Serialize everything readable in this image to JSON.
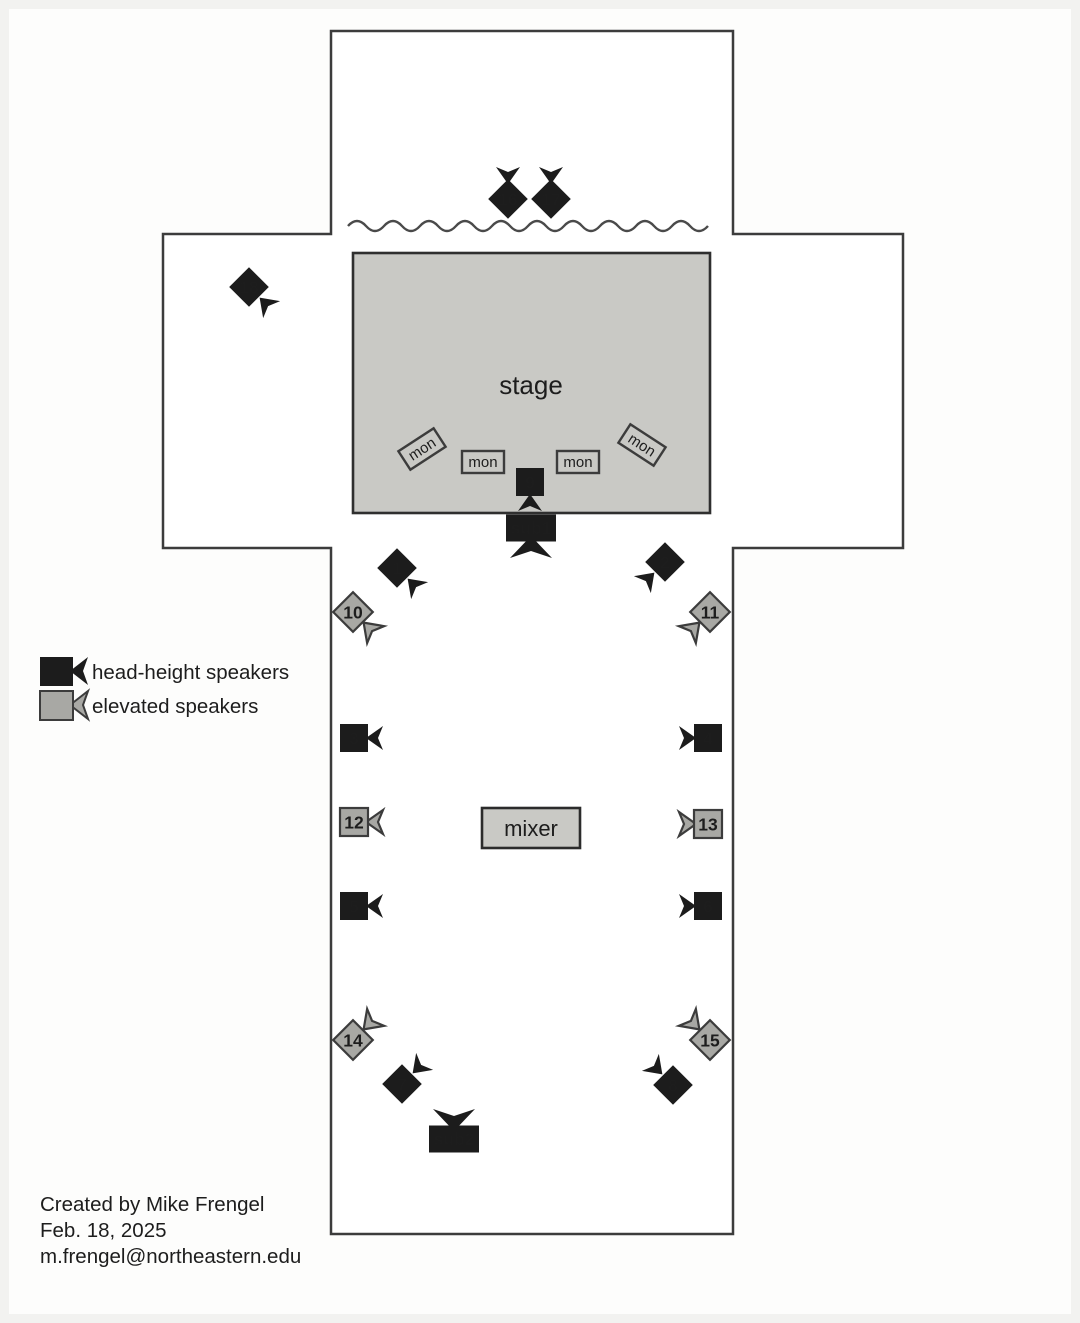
{
  "stage": {
    "label": "stage"
  },
  "mixer": {
    "label": "mixer"
  },
  "legend": {
    "items": [
      {
        "label": "head-height speakers",
        "type": "head-height"
      },
      {
        "label": "elevated speakers",
        "type": "elevated"
      }
    ]
  },
  "monitors": [
    {
      "label": "mon",
      "x": 422,
      "y": 449,
      "angle": -33
    },
    {
      "label": "mon",
      "x": 483,
      "y": 462,
      "angle": 0
    },
    {
      "label": "mon",
      "x": 578,
      "y": 462,
      "angle": 0
    },
    {
      "label": "mon",
      "x": 642,
      "y": 445,
      "angle": 33
    }
  ],
  "subwoofers": [
    {
      "label": "sub1",
      "x": 531,
      "y": 528,
      "horn_deg": 90
    },
    {
      "label": "sub2",
      "x": 454,
      "y": 1139,
      "horn_deg": -90
    }
  ],
  "speakers": [
    {
      "num": "1",
      "x": 397,
      "y": 568,
      "shape": "diamond",
      "type": "head-height",
      "horn_deg": 45,
      "num_color": "#ffffff"
    },
    {
      "num": "2",
      "x": 665,
      "y": 562,
      "shape": "diamond",
      "type": "head-height",
      "horn_deg": 135,
      "num_color": "#ffffff"
    },
    {
      "num": "3",
      "x": 354,
      "y": 738,
      "shape": "square",
      "type": "head-height",
      "horn_deg": 0,
      "num_color": "#ffffff"
    },
    {
      "num": "4",
      "x": 708,
      "y": 738,
      "shape": "square",
      "type": "head-height",
      "horn_deg": 180,
      "num_color": "#ffffff"
    },
    {
      "num": "5",
      "x": 354,
      "y": 906,
      "shape": "square",
      "type": "head-height",
      "horn_deg": 0,
      "num_color": "#ffffff"
    },
    {
      "num": "6",
      "x": 708,
      "y": 906,
      "shape": "square",
      "type": "head-height",
      "horn_deg": 180,
      "num_color": "#ffffff"
    },
    {
      "num": "7",
      "x": 402,
      "y": 1084,
      "shape": "diamond",
      "type": "head-height",
      "horn_deg": -45,
      "num_color": "#ffffff"
    },
    {
      "num": "8",
      "x": 673,
      "y": 1085,
      "shape": "diamond",
      "type": "head-height",
      "horn_deg": -135,
      "num_color": "#ffffff"
    },
    {
      "num": "9",
      "x": 530,
      "y": 482,
      "shape": "square",
      "type": "head-height",
      "horn_deg": 90,
      "num_color": "#ffffff"
    },
    {
      "num": "10",
      "x": 353,
      "y": 612,
      "shape": "diamond",
      "type": "elevated",
      "horn_deg": 45,
      "num_color": "#efefed"
    },
    {
      "num": "11",
      "x": 710,
      "y": 612,
      "shape": "diamond",
      "type": "elevated",
      "horn_deg": 135,
      "num_color": "#efefed"
    },
    {
      "num": "12",
      "x": 354,
      "y": 822,
      "shape": "square",
      "type": "elevated",
      "horn_deg": 0,
      "num_color": "#1d1d1d"
    },
    {
      "num": "13",
      "x": 708,
      "y": 824,
      "shape": "square",
      "type": "elevated",
      "horn_deg": 180,
      "num_color": "#1d1d1d"
    },
    {
      "num": "14",
      "x": 353,
      "y": 1040,
      "shape": "diamond",
      "type": "elevated",
      "horn_deg": -45,
      "num_color": "#efefed"
    },
    {
      "num": "15",
      "x": 710,
      "y": 1040,
      "shape": "diamond",
      "type": "elevated",
      "horn_deg": -135,
      "num_color": "#efefed"
    },
    {
      "num": "16",
      "x": 508,
      "y": 199,
      "shape": "diamond",
      "type": "head-height",
      "horn_deg": -90,
      "num_color": "#ffffff"
    },
    {
      "num": "17",
      "x": 551,
      "y": 199,
      "shape": "diamond",
      "type": "head-height",
      "horn_deg": -90,
      "num_color": "#ffffff"
    },
    {
      "num": "18",
      "x": 249,
      "y": 287,
      "shape": "diamond",
      "type": "head-height",
      "horn_deg": 45,
      "num_color": "#ffffff"
    }
  ],
  "footer": {
    "lines": [
      "Created by Mike Frengel",
      "Feb. 18, 2025",
      "m.frengel@northeastern.edu"
    ]
  },
  "colors": {
    "speaker_black": "#1c1c1c",
    "speaker_gray": "#a8a8a4",
    "stage_fill": "#c9c9c5",
    "outline": "#3c3c3c",
    "text": "#1d1d1d"
  }
}
